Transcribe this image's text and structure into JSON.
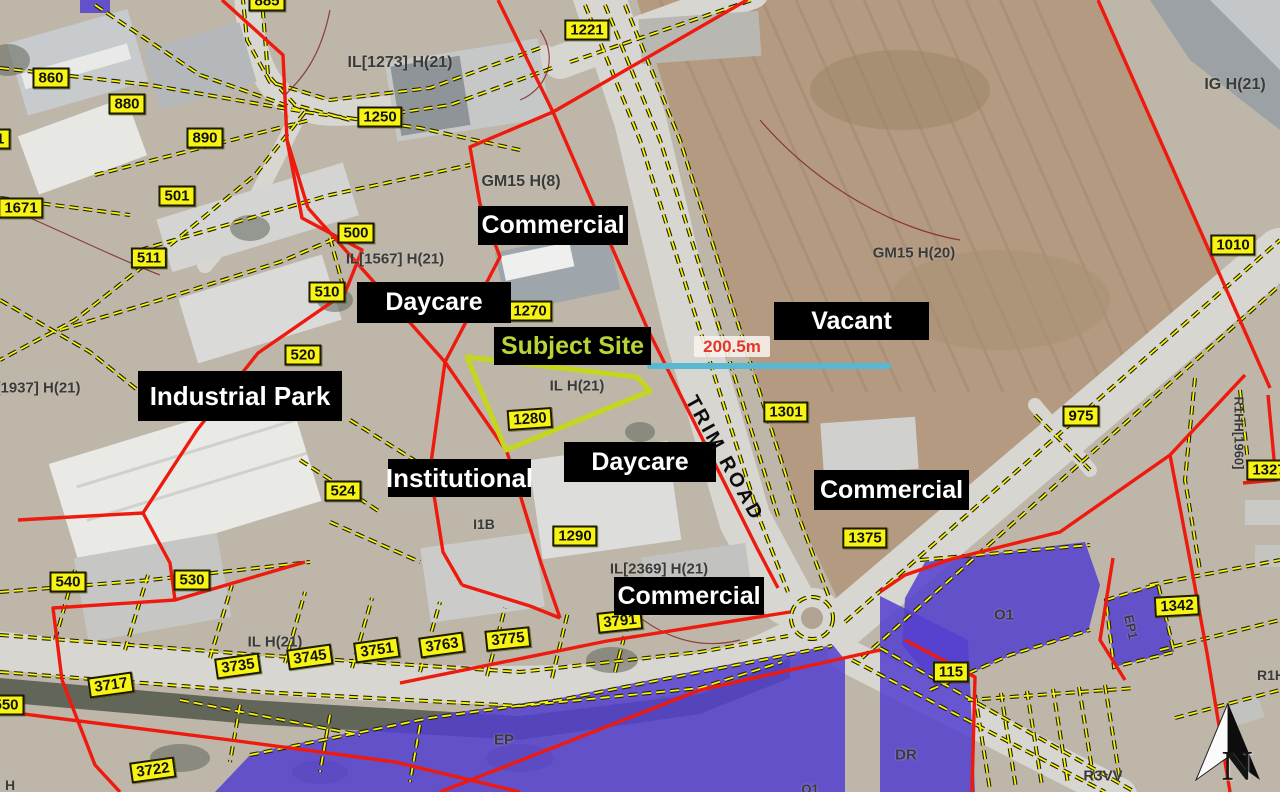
{
  "map": {
    "colors": {
      "red_boundary": "#ee1a0e",
      "parcel_chip_yellow": "#f7f312",
      "zone_purple": "#5340cf",
      "subject_site_lime": "#c4d71d",
      "measure_cyan": "#56b8d2",
      "field_tan": "#b39a80",
      "road_gray": "#d8d6d0",
      "label_bg": "#000000",
      "subject_text_green": "#b8d435"
    },
    "measurement_label": "200.5m",
    "road_label": "TRIM ROAD",
    "north_label": "N",
    "black_labels": [
      {
        "t": "Commercial",
        "x": 478,
        "y": 206,
        "w": 150,
        "h": 39
      },
      {
        "t": "Daycare",
        "x": 357,
        "y": 282,
        "w": 154,
        "h": 41
      },
      {
        "t": "Subject Site",
        "x": 494,
        "y": 327,
        "w": 157,
        "h": 38,
        "c": "#b8d435"
      },
      {
        "t": "Industrial Park",
        "x": 138,
        "y": 371,
        "w": 204,
        "h": 50
      },
      {
        "t": "Vacant",
        "x": 774,
        "y": 302,
        "w": 155,
        "h": 38
      },
      {
        "t": "Institutional",
        "x": 388,
        "y": 459,
        "w": 143,
        "h": 38
      },
      {
        "t": "Daycare",
        "x": 564,
        "y": 442,
        "w": 152,
        "h": 40
      },
      {
        "t": "Commercial",
        "x": 814,
        "y": 470,
        "w": 155,
        "h": 40
      },
      {
        "t": "Commercial",
        "x": 614,
        "y": 577,
        "w": 150,
        "h": 38
      }
    ],
    "parcel_chips": [
      {
        "t": "885",
        "x": 267,
        "y": 1,
        "r": 0
      },
      {
        "t": "860",
        "x": 51,
        "y": 78,
        "r": 0
      },
      {
        "t": "880",
        "x": 127,
        "y": 104,
        "r": 0
      },
      {
        "t": "61",
        "x": -4,
        "y": 139,
        "r": 0
      },
      {
        "t": "890",
        "x": 205,
        "y": 138,
        "r": 0
      },
      {
        "t": "501",
        "x": 177,
        "y": 196,
        "r": 0
      },
      {
        "t": "1671",
        "x": 21,
        "y": 208,
        "r": 0
      },
      {
        "t": "511",
        "x": 149,
        "y": 258,
        "r": 0
      },
      {
        "t": "500",
        "x": 356,
        "y": 233,
        "r": 0
      },
      {
        "t": "510",
        "x": 327,
        "y": 292,
        "r": 0
      },
      {
        "t": "1250",
        "x": 380,
        "y": 117,
        "r": 0
      },
      {
        "t": "1221",
        "x": 587,
        "y": 30,
        "r": 0
      },
      {
        "t": "1010",
        "x": 1233,
        "y": 245,
        "r": 0
      },
      {
        "t": "1270",
        "x": 530,
        "y": 311,
        "r": 0
      },
      {
        "t": "520",
        "x": 303,
        "y": 355,
        "r": 0
      },
      {
        "t": "1280",
        "x": 530,
        "y": 419,
        "r": -4
      },
      {
        "t": "524",
        "x": 343,
        "y": 491,
        "r": 0
      },
      {
        "t": "1290",
        "x": 575,
        "y": 536,
        "r": 0
      },
      {
        "t": "1301",
        "x": 786,
        "y": 412,
        "r": 0
      },
      {
        "t": "975",
        "x": 1081,
        "y": 416,
        "r": 0
      },
      {
        "t": "1375",
        "x": 865,
        "y": 538,
        "r": 0
      },
      {
        "t": "530",
        "x": 192,
        "y": 580,
        "r": 0
      },
      {
        "t": "540",
        "x": 68,
        "y": 582,
        "r": 0
      },
      {
        "t": "550",
        "x": 6,
        "y": 705,
        "r": 0
      },
      {
        "t": "3717",
        "x": 111,
        "y": 685,
        "r": -8
      },
      {
        "t": "3735",
        "x": 238,
        "y": 666,
        "r": -8
      },
      {
        "t": "3745",
        "x": 310,
        "y": 657,
        "r": -8
      },
      {
        "t": "3751",
        "x": 377,
        "y": 650,
        "r": -8
      },
      {
        "t": "3763",
        "x": 442,
        "y": 645,
        "r": -8
      },
      {
        "t": "3775",
        "x": 508,
        "y": 639,
        "r": -6
      },
      {
        "t": "3791",
        "x": 620,
        "y": 621,
        "r": -6
      },
      {
        "t": "3722",
        "x": 153,
        "y": 770,
        "r": -8
      },
      {
        "t": "115",
        "x": 951,
        "y": 672,
        "r": 0
      },
      {
        "t": "1342",
        "x": 1177,
        "y": 606,
        "r": -3
      },
      {
        "t": "1327",
        "x": 1269,
        "y": 470,
        "r": 0
      }
    ],
    "zone_codes": [
      {
        "t": "IL[1273] H(21)",
        "x": 400,
        "y": 63,
        "r": 0,
        "s": 16
      },
      {
        "t": "GM15 H(8)",
        "x": 521,
        "y": 182,
        "r": 0,
        "s": 16
      },
      {
        "t": "IG H(21)",
        "x": 1235,
        "y": 85,
        "r": 0,
        "s": 16
      },
      {
        "t": "GM15 H(20)",
        "x": 914,
        "y": 253,
        "r": 0,
        "s": 15
      },
      {
        "t": "IL[1567] H(21)",
        "x": 395,
        "y": 259,
        "r": 0,
        "s": 15
      },
      {
        "t": "IL H(21)",
        "x": 577,
        "y": 386,
        "r": 0,
        "s": 15
      },
      {
        "t": "[1937] H(21)",
        "x": 38,
        "y": 388,
        "r": 0,
        "s": 15
      },
      {
        "t": "I1B",
        "x": 484,
        "y": 524,
        "r": 0,
        "s": 14
      },
      {
        "t": "IL[2369] H(21)",
        "x": 659,
        "y": 569,
        "r": 0,
        "s": 15
      },
      {
        "t": "IL H(21)",
        "x": 275,
        "y": 642,
        "r": 0,
        "s": 15
      },
      {
        "t": "R1HH[1960]",
        "x": 1239,
        "y": 433,
        "r": 90,
        "s": 13
      },
      {
        "t": "EP1",
        "x": 1131,
        "y": 627,
        "r": 78,
        "s": 13
      },
      {
        "t": "O1",
        "x": 1004,
        "y": 615,
        "r": 0,
        "s": 15
      },
      {
        "t": "DR",
        "x": 906,
        "y": 755,
        "r": 0,
        "s": 15
      },
      {
        "t": "R3VV",
        "x": 1103,
        "y": 776,
        "r": 0,
        "s": 15
      },
      {
        "t": "R1H",
        "x": 1271,
        "y": 675,
        "r": 0,
        "s": 14
      },
      {
        "t": "EP",
        "x": 504,
        "y": 740,
        "r": 0,
        "s": 15
      },
      {
        "t": "O1",
        "x": 810,
        "y": 789,
        "r": 0,
        "s": 13
      },
      {
        "t": "H",
        "x": 10,
        "y": 785,
        "r": 0,
        "s": 14
      }
    ]
  }
}
